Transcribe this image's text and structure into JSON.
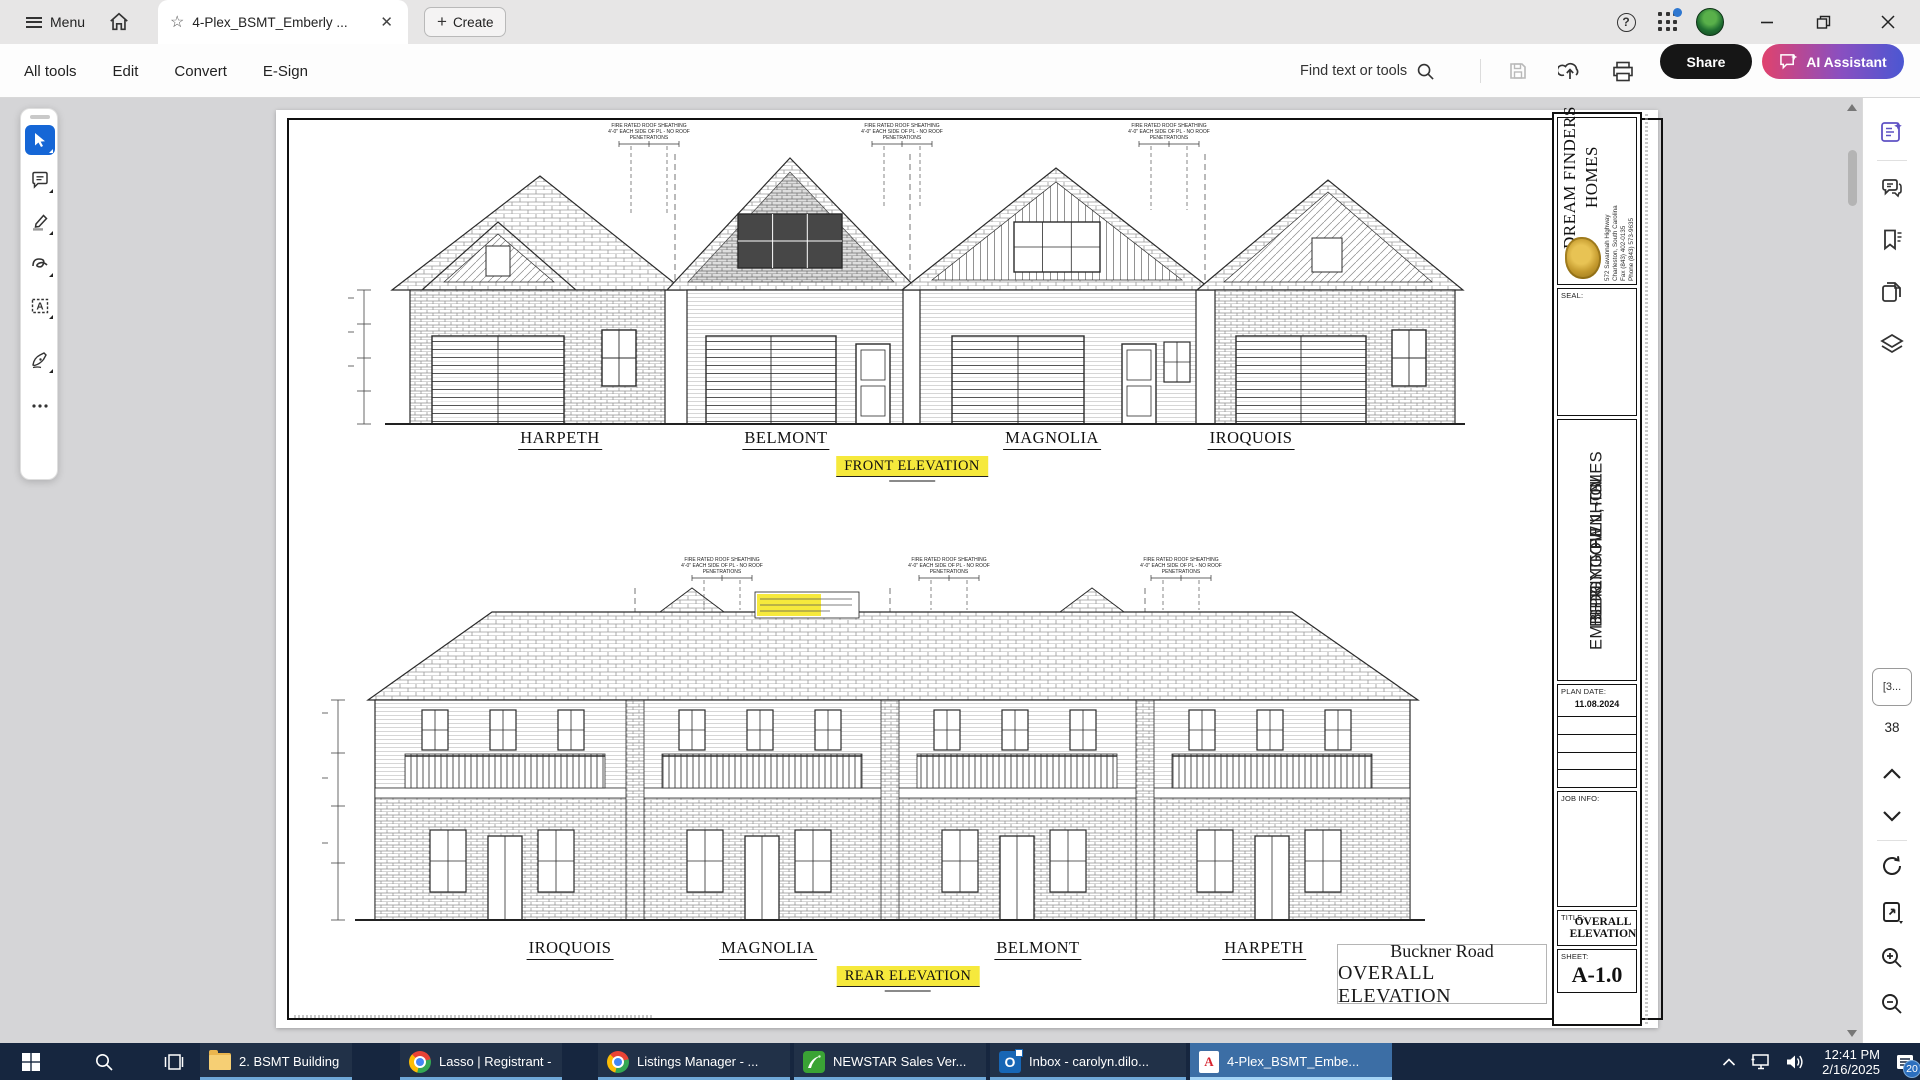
{
  "titlebar": {
    "menu": "Menu",
    "tab_title": "4-Plex_BSMT_Emberly ...",
    "create": "Create",
    "help": "?"
  },
  "toolbar": {
    "items": [
      "All tools",
      "Edit",
      "Convert",
      "E-Sign"
    ],
    "find": "Find text or tools",
    "share": "Share",
    "ai": "AI Assistant"
  },
  "tool_dock": {
    "icons": [
      "select-tool",
      "add-comment-tool",
      "highlight-tool",
      "draw-tool",
      "select-text-box-tool",
      "fill-sign-tool",
      "more-tools"
    ]
  },
  "document": {
    "front": {
      "units": [
        "HARPETH",
        "BELMONT",
        "MAGNOLIA",
        "IROQUOIS"
      ],
      "caption": "FRONT ELEVATION"
    },
    "rear": {
      "units": [
        "IROQUOIS",
        "MAGNOLIA",
        "BELMONT",
        "HARPETH"
      ],
      "caption": "REAR ELEVATION"
    },
    "note_lines": [
      "FIRE RATED ROOF SHEATHING",
      "4'-0\" EACH SIDE OF PL - NO ROOF",
      "PENETRATIONS"
    ],
    "address": {
      "line1": "Buckner Road",
      "line2": "OVERALL ELEVATION"
    },
    "titleblock": {
      "company_line1": "DREAM FINDERS",
      "company_line2": "HOMES",
      "addr1": "572 Savannah Highway",
      "addr2": "Charleston, South Carolina",
      "fax": "Fax (843) 402-0135",
      "phone": "Phone (843) 573-9635",
      "seal_label": "SEAL:",
      "project_line1": "EMBERLY TOWNHOMES",
      "project_line2": "BLDG. TYPE 1 - GL",
      "project_line3": "SPRING HILL, TN",
      "plan_date_label": "PLAN DATE:",
      "plan_date": "11.08.2024",
      "job_info_label": "JOB INFO:",
      "title_label": "TITLE:",
      "title": "OVERALL ELEVATION",
      "sheet_label": "SHEET:",
      "sheet": "A-1.0"
    }
  },
  "right_rail": {
    "icons": [
      "ai-assistant-panel",
      "comments-panel",
      "bookmarks-panel",
      "page-thumbnails-panel",
      "layers-panel",
      "page-up",
      "page-down",
      "refresh-page",
      "export-page",
      "zoom-in",
      "zoom-out"
    ],
    "page_box": "[3...",
    "page_count": "38"
  },
  "taskbar": {
    "apps": [
      {
        "label": "2. BSMT Building"
      },
      {
        "label": "Lasso | Registrant - ..."
      },
      {
        "label": "Listings Manager - ..."
      },
      {
        "label": "NEWSTAR Sales Ver..."
      },
      {
        "label": "Inbox - carolyn.dilo..."
      },
      {
        "label": "4-Plex_BSMT_Embe..."
      }
    ],
    "clock": {
      "time": "12:41 PM",
      "date": "2/16/2025"
    },
    "badge": "20"
  },
  "colors": {
    "accent_blue": "#1566d6",
    "highlight_yellow": "#f6e93c",
    "taskbar_navy": "#16263f",
    "ai_gradient_start": "#e0426d",
    "ai_gradient_end": "#4b57d2",
    "share_black": "#161616"
  }
}
